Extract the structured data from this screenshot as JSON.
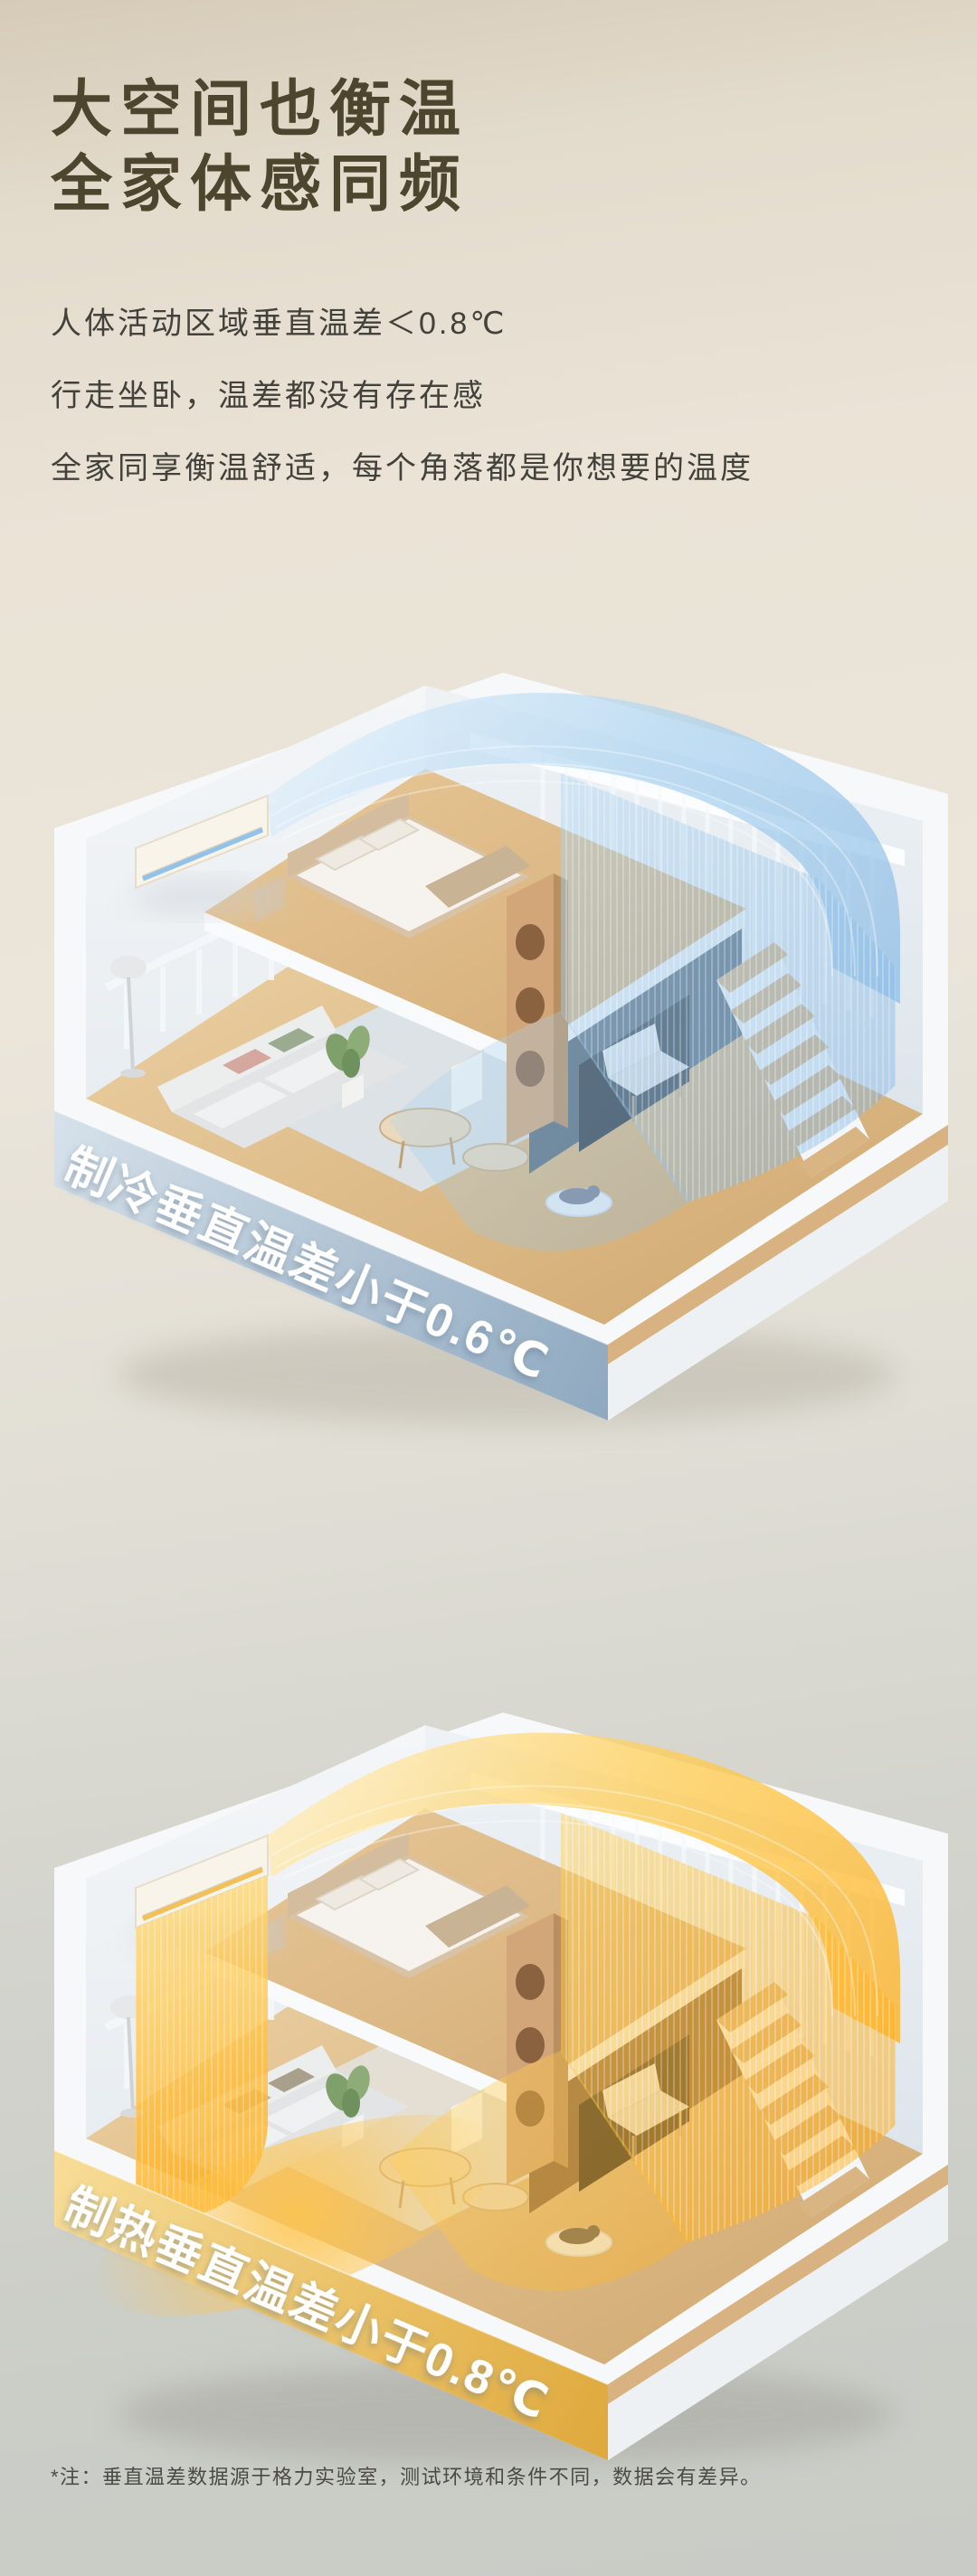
{
  "header": {
    "title_line1": "大空间也衡温",
    "title_line2": "全家体感同频"
  },
  "intro": {
    "lines": [
      "人体活动区域垂直温差＜0.8℃",
      "行走坐卧，温差都没有存在感",
      "全家同享衡温舒适，每个角落都是你想要的温度"
    ]
  },
  "figures": {
    "cooling": {
      "banner": "制冷垂直温差小于0.6℃",
      "mode": "cooling",
      "airflow_color": "#9fc9ec",
      "banner_color_from": "#d6e1ea",
      "banner_color_to": "#8fa9c0"
    },
    "heating": {
      "banner": "制热垂直温差小于0.8℃",
      "mode": "heating",
      "airflow_color": "#ffc23d",
      "banner_color_from": "#f8dd97",
      "banner_color_to": "#dfa93c"
    }
  },
  "footnote": {
    "text": "*注：垂直温差数据源于格力实验室，测试环境和条件不同，数据会有差异。"
  },
  "theme": {
    "background-top": "#d6cbb8",
    "background-bottom": "#c9ccc6",
    "title-color": "#4e452f",
    "body-color": "#43413b",
    "footnote-color": "#4b4a45",
    "cool-accent": "#9fc9ec",
    "warm-accent": "#ffc23d",
    "wall-color": "#f2f5f7",
    "wood-color": "#d9b584"
  }
}
